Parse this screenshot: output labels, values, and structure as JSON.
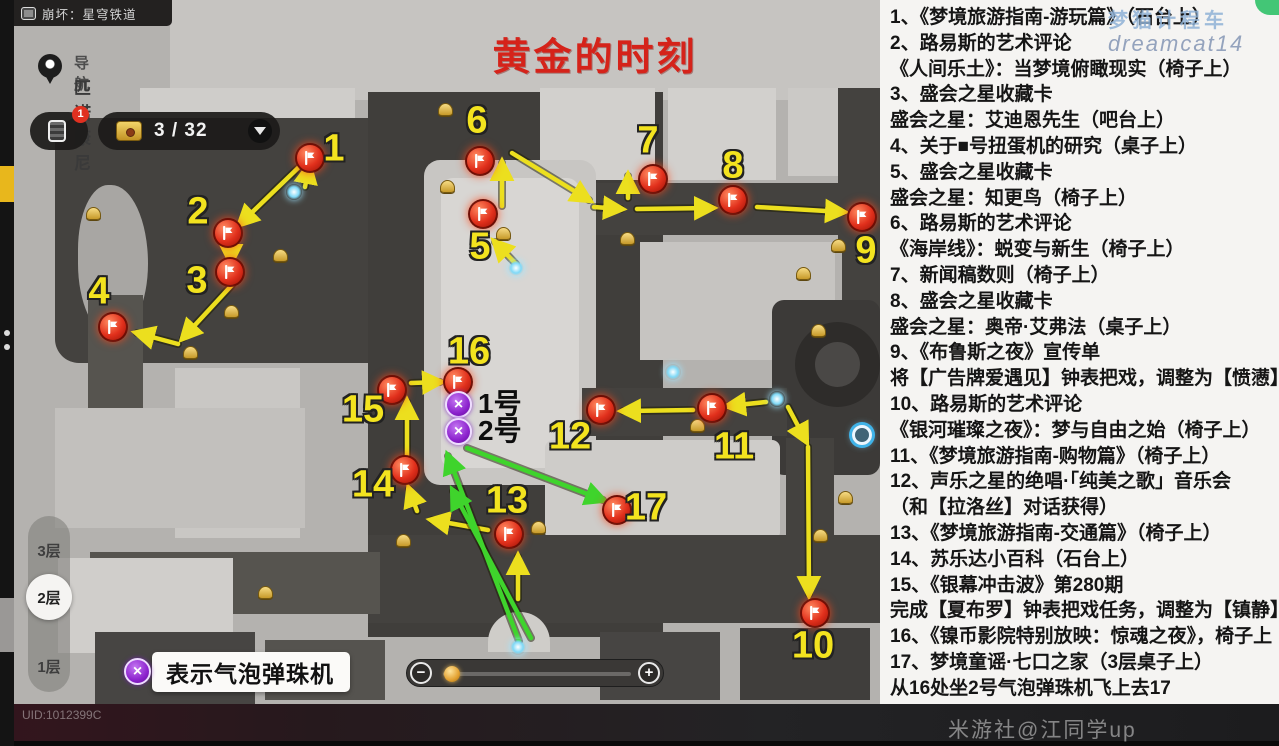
{
  "window": {
    "title": "崩坏：星穹铁道"
  },
  "map": {
    "title": "黄金的时刻",
    "nav": {
      "label": "导航",
      "location": "匹诺康尼"
    },
    "counter": {
      "value": "3 / 32",
      "badge": "1"
    },
    "floors": [
      {
        "label": "3层",
        "selected": false
      },
      {
        "label": "2层",
        "selected": true
      },
      {
        "label": "1层",
        "selected": false
      }
    ],
    "legend": {
      "text": "表示气泡弹珠机"
    },
    "slider": {
      "minus": "−",
      "plus": "+"
    },
    "markers": [
      {
        "n": 1,
        "fx": 310,
        "fy": 158,
        "lx": 334,
        "ly": 149
      },
      {
        "n": 2,
        "fx": 228,
        "fy": 233,
        "lx": 198,
        "ly": 212
      },
      {
        "n": 3,
        "fx": 230,
        "fy": 272,
        "lx": 197,
        "ly": 281
      },
      {
        "n": 4,
        "fx": 113,
        "fy": 327,
        "lx": 99,
        "ly": 292
      },
      {
        "n": 5,
        "fx": 483,
        "fy": 214,
        "lx": 480,
        "ly": 247
      },
      {
        "n": 6,
        "fx": 480,
        "fy": 161,
        "lx": 477,
        "ly": 121
      },
      {
        "n": 7,
        "fx": 653,
        "fy": 179,
        "lx": 648,
        "ly": 141
      },
      {
        "n": 8,
        "fx": 733,
        "fy": 200,
        "lx": 733,
        "ly": 166
      },
      {
        "n": 9,
        "fx": 862,
        "fy": 217,
        "lx": 866,
        "ly": 251
      },
      {
        "n": 10,
        "fx": 815,
        "fy": 613,
        "lx": 813,
        "ly": 646
      },
      {
        "n": 11,
        "fx": 712,
        "fy": 408,
        "lx": 734,
        "ly": 447
      },
      {
        "n": 12,
        "fx": 601,
        "fy": 410,
        "lx": 570,
        "ly": 437
      },
      {
        "n": 13,
        "fx": 509,
        "fy": 534,
        "lx": 507,
        "ly": 501
      },
      {
        "n": 14,
        "fx": 405,
        "fy": 470,
        "lx": 373,
        "ly": 485
      },
      {
        "n": 15,
        "fx": 392,
        "fy": 390,
        "lx": 363,
        "ly": 410
      },
      {
        "n": 16,
        "fx": 458,
        "fy": 382,
        "lx": 469,
        "ly": 352
      },
      {
        "n": 17,
        "fx": 617,
        "fy": 510,
        "lx": 646,
        "ly": 508
      }
    ],
    "pinballs": [
      {
        "x": 458,
        "y": 404,
        "label": "1号"
      },
      {
        "x": 458,
        "y": 431,
        "label": "2号"
      }
    ],
    "bells": [
      [
        93,
        213
      ],
      [
        280,
        255
      ],
      [
        231,
        311
      ],
      [
        190,
        352
      ],
      [
        447,
        186
      ],
      [
        503,
        233
      ],
      [
        627,
        238
      ],
      [
        838,
        245
      ],
      [
        803,
        273
      ],
      [
        818,
        330
      ],
      [
        697,
        425
      ],
      [
        845,
        497
      ],
      [
        820,
        535
      ],
      [
        538,
        527
      ],
      [
        403,
        540
      ],
      [
        445,
        109
      ],
      [
        265,
        592
      ]
    ],
    "sprites": [
      [
        294,
        192
      ],
      [
        516,
        268
      ],
      [
        673,
        372
      ],
      [
        777,
        399
      ],
      [
        518,
        647
      ]
    ],
    "teleport": {
      "x": 862,
      "y": 435
    },
    "arrows": {
      "yellow": [
        [
          305,
          187,
          309,
          166
        ],
        [
          298,
          168,
          240,
          224
        ],
        [
          231,
          247,
          231,
          262
        ],
        [
          232,
          285,
          183,
          338
        ],
        [
          178,
          344,
          137,
          333
        ],
        [
          516,
          264,
          495,
          242
        ],
        [
          502,
          206,
          502,
          163
        ],
        [
          512,
          153,
          589,
          200
        ],
        [
          594,
          207,
          621,
          209
        ],
        [
          628,
          198,
          628,
          176
        ],
        [
          637,
          209,
          712,
          208
        ],
        [
          757,
          207,
          843,
          212
        ],
        [
          788,
          407,
          806,
          441
        ],
        [
          808,
          447,
          809,
          594
        ],
        [
          766,
          402,
          728,
          406
        ],
        [
          693,
          410,
          623,
          411
        ],
        [
          518,
          599,
          518,
          557
        ],
        [
          488,
          530,
          432,
          520
        ],
        [
          417,
          511,
          409,
          489
        ],
        [
          407,
          457,
          407,
          402
        ],
        [
          411,
          383,
          440,
          382
        ]
      ],
      "green": [
        [
          519,
          641,
          448,
          456
        ],
        [
          531,
          638,
          453,
          491
        ],
        [
          467,
          448,
          603,
          500
        ]
      ]
    }
  },
  "panel": {
    "lines": [
      "1、《梦境旅游指南-游玩篇》（石台上）",
      "2、路易斯的艺术评论",
      "《人间乐土》：当梦境俯瞰现实（椅子上）",
      "3、盛会之星收藏卡",
      "盛会之星：艾迪恩先生（吧台上）",
      "4、关于■号扭蛋机的研究（桌子上）",
      "5、盛会之星收藏卡",
      "盛会之星：知更鸟（椅子上）",
      "6、路易斯的艺术评论",
      "《海岸线》：蜕变与新生（椅子上）",
      "7、新闻稿数则（椅子上）",
      "8、盛会之星收藏卡",
      "盛会之星：奥帝·艾弗法（桌子上）",
      "9、《布鲁斯之夜》宣传单",
      "将【广告牌爱遇见】钟表把戏，调整为【愤懑】",
      "10、路易斯的艺术评论",
      "《银河璀璨之夜》：梦与自由之始（椅子上）",
      "11、《梦境旅游指南-购物篇》（椅子上）",
      "12、声乐之星的绝唱·「纯美之歌」音乐会",
      "（和【拉洛丝】对话获得）",
      "13、《梦境旅游指南-交通篇》（椅子上）",
      "14、苏乐达小百科（石台上）",
      "15、《银幕冲击波》第280期",
      "完成【夏布罗】钟表把戏任务，调整为【镇静】",
      "16、《镍币影院特别放映：惊魂之夜》，椅子上",
      "17、梦境童谣·七口之家（3层桌子上）",
      "从16处坐2号气泡弹珠机飞上去17"
    ]
  },
  "watermarks": {
    "top1": "梦猫计程车",
    "top2": "dreamcat14",
    "bottom_right": "米游社@江同学up",
    "uid": "UID:1012399C"
  },
  "colors": {
    "accent_red": "#d5231a",
    "arrow_yellow": "#ecdf1e",
    "arrow_green": "#3fd42c",
    "flag_red": "#e1301c",
    "pinball_purple": "#8b21cc"
  }
}
